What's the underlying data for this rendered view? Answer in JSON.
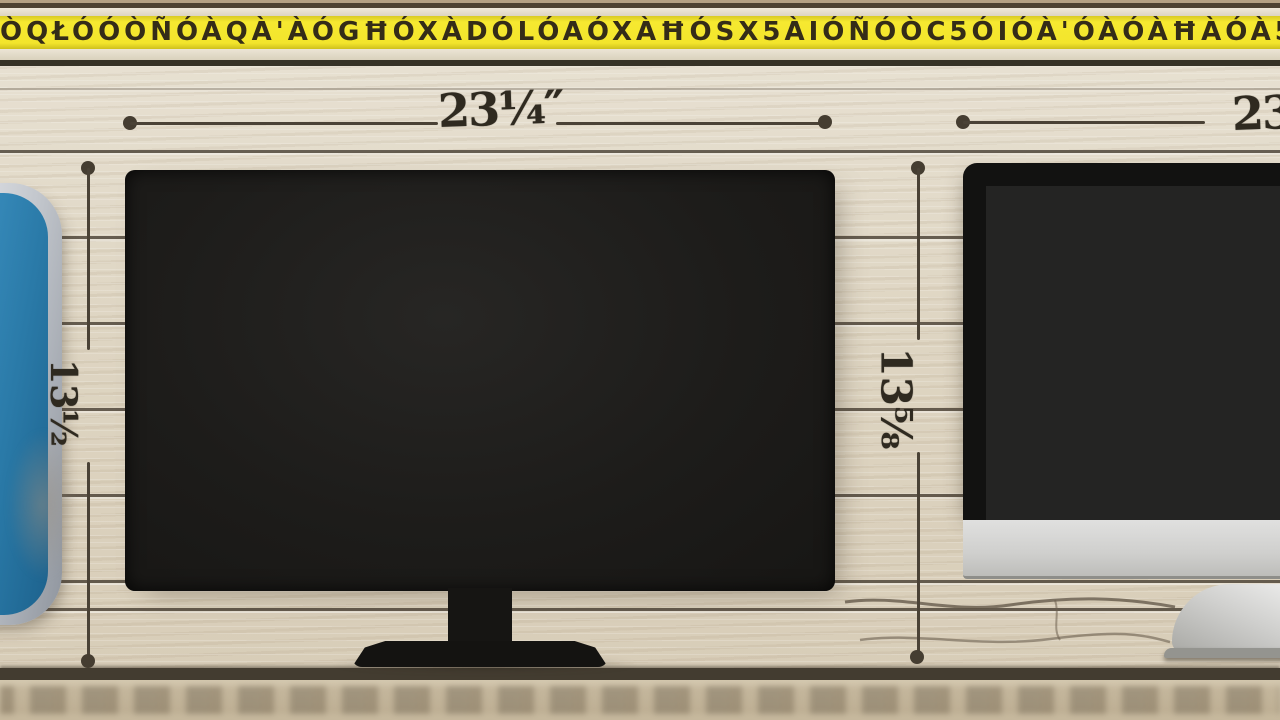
{
  "tape": {
    "markings": "ÒQŁÓÓÒÑÓÀQÀ'ÀÓGĦÓXÀDÓLÓAÓXÀĦÓSX5ÀIÓÑÓÒC5ÓIÓÀ'ÓÀÓÀĦÀÓÀ5ÑÓĦ(ÀÓJÓR/G5ÓÀÒÓCÓNÓÒÈ5ÓIÓÀÓXÓÀDÒGIÒ"
  },
  "annotations": {
    "left_width_label": "23¼″",
    "right_width_label": "23",
    "left_height_label": "13½",
    "middle_height_label": "13⅝"
  },
  "colors": {
    "wood": "#ded5c2",
    "plank_line": "#423a2e",
    "tape_yellow": "#f3e52c",
    "screen_black": "#1d1c1a",
    "imac_silver": "#cfcfcd",
    "device_blue": "#2a7aa8",
    "annotation_ink": "#4a4236"
  }
}
